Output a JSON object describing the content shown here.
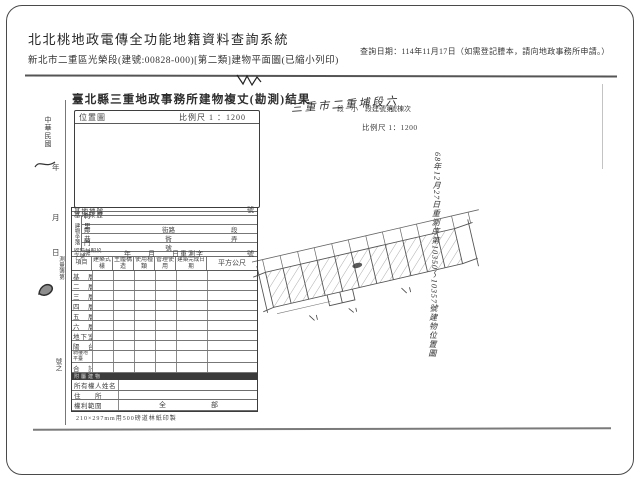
{
  "header": {
    "system_title": "北北桃地政電傳全功能地籍資料查詢系統",
    "query_date": "查詢日期：114年11月17日（如需登記謄本，請向地政事務所申請。）",
    "subtitle": "新北市二重區光榮段(建號:00828-000)[第二類]建物平面圖(已縮小列印)"
  },
  "scan": {
    "form_title": "臺北縣三重地政事務所建物複丈(勘測)結果",
    "location_box": {
      "label": "位置圖",
      "scale": "比例尺 1 ：1200"
    },
    "handwritten_header": {
      "handwritten": "三重市二重埔段六",
      "printed_left": "段　小　段建號第",
      "printed_right": "號棟次",
      "scale": "比例尺 1：1200"
    },
    "side_note_vertical": "68年12月27日重測序第10350～10357號建物位置圖",
    "left_margin": {
      "era": "中華民國",
      "year": "年",
      "month": "月",
      "day": "日",
      "survey_book": "測量簿第",
      "number": "號之"
    },
    "fields": {
      "row1": {
        "label": "基地地號",
        "suffix": "號"
      },
      "row2": {
        "label": "基地來歷"
      },
      "location_group": {
        "label": "建物坐落",
        "rows": [
          {
            "label": "村　里",
            "mid": "",
            "suffix": ""
          },
          {
            "label": "鄰",
            "mid": "街路",
            "suffix": "段"
          },
          {
            "label": "巷",
            "mid": "衖",
            "suffix": "弄"
          },
          {
            "label": "門　牌",
            "mid": "號",
            "suffix": ""
          }
        ]
      },
      "receipt": {
        "label": "收件日期及字號",
        "value": "年　　月　　日重測字",
        "suffix": "號"
      }
    },
    "grid": {
      "headers": [
        "項目",
        "建築式樣",
        "主體構造",
        "使用種類",
        "管理使用",
        "建築完成日期",
        "平方公尺"
      ],
      "rows": [
        "基　層",
        "二　層",
        "三　層",
        "四　層",
        "五　層",
        "六　層",
        "地下室",
        "陽　台",
        "騎樓地平臺",
        "合　計"
      ],
      "dark_row": "附屬建物"
    },
    "owner_rows": [
      {
        "label": "所有權人姓名",
        "value": ""
      },
      {
        "label": "住　　所",
        "value": ""
      },
      {
        "label": "權利範圍",
        "value": "全　　　部"
      }
    ],
    "footer_note": "210×297mm用500磅道林紙印製"
  }
}
